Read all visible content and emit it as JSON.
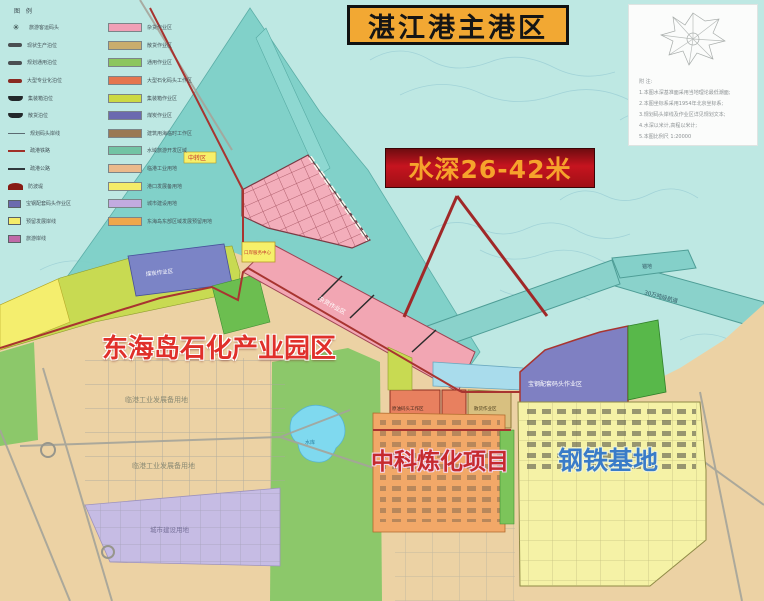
{
  "title": "湛江港主港区",
  "depth_label": "水深26-42米",
  "labels": {
    "park": "东海岛石化产业园区",
    "zhongke": "中科炼化项目",
    "steel": "钢铁基地"
  },
  "colors": {
    "water": "#bee8e3",
    "shoal": "#7fd0c9",
    "land": "#ecd2a4",
    "title_box": "#f2a833",
    "depth_box_red": "#c6141f",
    "park_label_red": "#e0302a",
    "steel_label_blue": "#3a7cc8",
    "boundary_red": "#a83430"
  },
  "legend": {
    "title": "图 例",
    "symbol_items": [
      {
        "symbol": "sym-anchor",
        "glyph": "✳",
        "label": "旅游客运码头"
      },
      {
        "symbol": "sym-blob",
        "label": "现状生产泊位"
      },
      {
        "symbol": "sym-blob",
        "label": "规划通用泊位"
      },
      {
        "symbol": "sym-blob-red",
        "label": "大型专业化泊位"
      },
      {
        "symbol": "sym-ship",
        "label": "集装箱泊位"
      },
      {
        "symbol": "sym-ship",
        "label": "散货泊位"
      },
      {
        "symbol": "sym-line",
        "label": "规划码头岸线"
      },
      {
        "symbol": "sym-line-red",
        "label": "疏港铁路"
      },
      {
        "symbol": "sym-line-dark",
        "label": "疏港公路"
      },
      {
        "symbol": "sym-arc",
        "label": "防波堤"
      },
      {
        "symbol": "sym-rect",
        "color": "#6b6aaf",
        "label": "宝钢配套码头作业区"
      },
      {
        "symbol": "sym-rect",
        "color": "#f4ec69",
        "label": "预留发展岸线"
      },
      {
        "symbol": "sym-rect",
        "color": "#c06aa8",
        "label": "旅游岸线"
      }
    ],
    "area_items": [
      {
        "color": "#f0a0b6",
        "label": "杂货作业区"
      },
      {
        "color": "#c9ad6d",
        "label": "散货作业区"
      },
      {
        "color": "#8cc65e",
        "label": "通用作业区"
      },
      {
        "color": "#e4764f",
        "label": "大型石化码头工作区"
      },
      {
        "color": "#ccd943",
        "label": "集装箱作业区"
      },
      {
        "color": "#6b6aaf",
        "label": "煤炭作业区"
      },
      {
        "color": "#9a7954",
        "label": "建筑用海临时工作区"
      },
      {
        "color": "#72c4a4",
        "label": "水域旅游开发区域"
      },
      {
        "color": "#eab98b",
        "label": "临港工业用地"
      },
      {
        "color": "#f4ec69",
        "label": "港口发展备用地"
      },
      {
        "color": "#c2abe0",
        "label": "城市建设用地"
      },
      {
        "color": "#efa74c",
        "label": "东海岛东部区域发展预留用地"
      }
    ]
  },
  "notes_box": {
    "lines": [
      "附 注:",
      "1.本图水深基准面采用当地理论最低潮面;",
      "2.本图坐标系采用1954年北京坐标系;",
      "3.规划码头岸线及作业区详见规划文本;",
      "4.水深以米计,高程以米计;",
      "5.本图比例尺 1:20000"
    ]
  },
  "annotations": {
    "industry": "临港工业发展备用地",
    "city": "城市建设用地",
    "grocery": "杂货作业区",
    "coal": "煤炭作业区",
    "baosteel": "宝钢配套码头作业区",
    "oil": "原油码头工作区",
    "bulk": "散货作业区",
    "channel": "30万吨级航道",
    "anchorage": "锚地",
    "transfer": "中转区",
    "service": "口岸服务中心",
    "lake": "水库"
  }
}
